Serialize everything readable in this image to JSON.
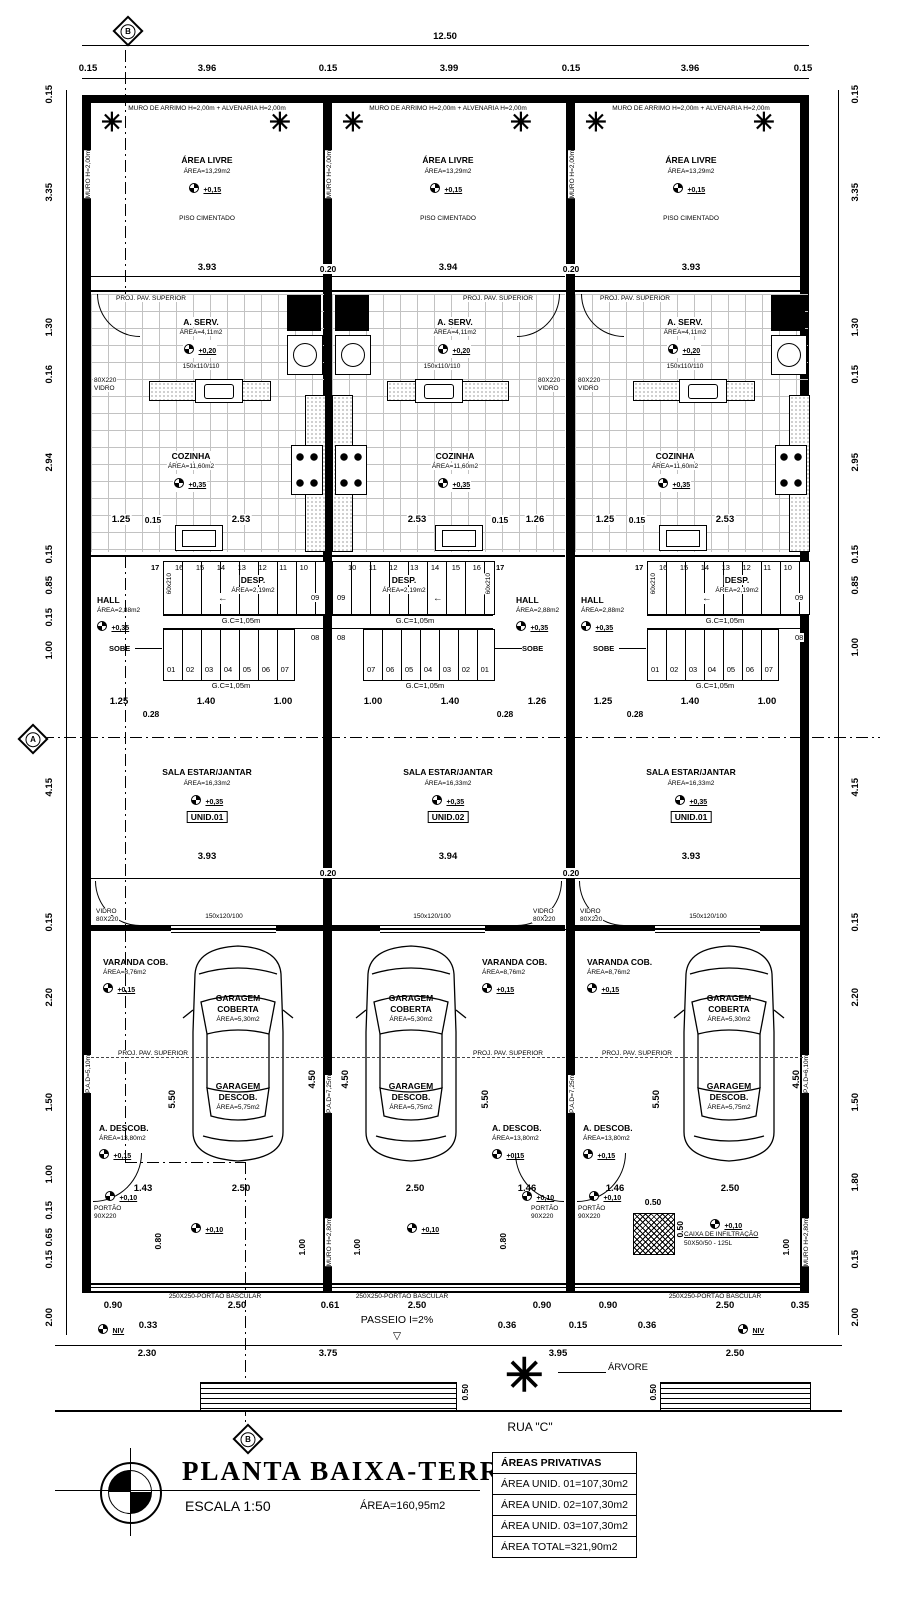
{
  "markers": {
    "a": "A",
    "b": "B"
  },
  "icons": {
    "palm": "✳",
    "arrow_left": "←",
    "triangle_down": "▽"
  },
  "dims": {
    "total": "12.50",
    "top": [
      "0.15",
      "3.96",
      "0.15",
      "3.99",
      "0.15",
      "3.96",
      "0.15"
    ],
    "left": [
      "0.15",
      "3.35",
      "1.30",
      "0.16",
      "2.94",
      "0.15",
      "0.85",
      "0.15",
      "1.00",
      "4.15",
      "0.15",
      "2.20",
      "1.50",
      "1.00",
      "0.15",
      "0.65",
      "0.15",
      "2.00"
    ],
    "right": [
      "0.15",
      "3.35",
      "1.30",
      "0.15",
      "2.95",
      "0.15",
      "0.85",
      "1.00",
      "4.15",
      "0.15",
      "2.20",
      "1.50",
      "1.80",
      "0.15",
      "2.00"
    ],
    "wall_020": "0.20"
  },
  "walls": {
    "muro_side": "MURO H=2,00m",
    "muro_low": "MURO H=2,80m",
    "pad_left": "P.A.D=5,10m",
    "pad_mid": "P.A.D=7,25m",
    "pad_right": "P.A.D=6,10m"
  },
  "units": [
    {
      "tag": "UNID.01",
      "muro_top": "MURO DE ARRIMO H=2,00m + ALVENARIA H=2,00m",
      "area_livre": {
        "name": "ÁREA LIVRE",
        "area": "ÁREA=13,29m2",
        "level": "+0,15",
        "floor": "PISO CIMENTADO",
        "width": "3.93"
      },
      "proj_pav": "PROJ. PAV. SUPERIOR",
      "a_serv": {
        "name": "A. SERV.",
        "area": "ÁREA=4,11m2",
        "level": "+0,20",
        "window": "150x110/110"
      },
      "vidro_rear": {
        "l1": "80X220",
        "l2": "VIDRO"
      },
      "cozinha": {
        "name": "COZINHA",
        "area": "ÁREA=11,60m2",
        "level": "+0,35",
        "dims": [
          "1.25",
          "0.15",
          "2.53"
        ]
      },
      "desp": {
        "name": "DESP.",
        "area": "ÁREA=2,19m2",
        "door": "60x210"
      },
      "hall": {
        "name": "HALL",
        "area": "ÁREA=2,88m2",
        "level": "+0,35"
      },
      "stairs": {
        "first": "17",
        "top_numbers": [
          "16",
          "15",
          "14",
          "13",
          "12",
          "11",
          "10"
        ],
        "right_top": "09",
        "right_mid": "08",
        "bottom_numbers": [
          "01",
          "02",
          "03",
          "04",
          "05",
          "06",
          "07"
        ],
        "gc1": "G.C=1,05m",
        "gc2": "G.C=1,05m",
        "sobe": "SOBE"
      },
      "hall_dims": {
        "a": "1.25",
        "b": "1.40",
        "c": "1.00",
        "sub": "0.28"
      },
      "sala": {
        "name": "SALA ESTAR/JANTAR",
        "area": "ÁREA=16,33m2",
        "level": "+0,35",
        "width": "3.93"
      },
      "front": {
        "vidro_l1": "VIDRO",
        "vidro_l2": "80X220",
        "window": "150x120/100"
      },
      "varanda": {
        "name": "VARANDA COB.",
        "area": "ÁREA=8,76m2",
        "level": "+0,15"
      },
      "gar_cob": {
        "l1": "GARAGEM",
        "l2": "COBERTA",
        "area": "ÁREA=5,30m2"
      },
      "proj_pav_gar": "PROJ. PAV. SUPERIOR",
      "gar_desc": {
        "l1": "GARAGEM",
        "l2": "DESCOB.",
        "area": "ÁREA=5,75m2"
      },
      "a_descob": {
        "name": "A. DESCOB.",
        "area": "ÁREA=13,80m2",
        "level": "+0,15"
      },
      "v_dims": {
        "d1": "5.50",
        "d2": "4.50"
      },
      "gate_dims": {
        "a": "1.43",
        "b": "2.50"
      },
      "portao": {
        "l1": "PORTÃO",
        "l2": "90X220"
      },
      "small_dims": {
        "a": "0.80",
        "b": "1.00"
      },
      "level_10": "+0,10",
      "bascular": "250X250-PORTÃO BASCULAR"
    },
    {
      "tag": "UNID.02",
      "muro_top": "MURO DE ARRIMO H=2,00m + ALVENARIA H=2,00m",
      "area_livre": {
        "name": "ÁREA LIVRE",
        "area": "ÁREA=13,29m2",
        "level": "+0,15",
        "floor": "PISO CIMENTADO",
        "width": "3.94"
      },
      "proj_pav": "PROJ. PAV. SUPERIOR",
      "a_serv": {
        "name": "A. SERV.",
        "area": "ÁREA=4,11m2",
        "level": "+0,20",
        "window": "150x110/110"
      },
      "vidro_rear": {
        "l1": "80X220",
        "l2": "VIDRO"
      },
      "cozinha": {
        "name": "COZINHA",
        "area": "ÁREA=11,60m2",
        "level": "+0,35",
        "dims": [
          "2.53",
          "0.15",
          "1.26"
        ]
      },
      "desp": {
        "name": "DESP.",
        "area": "ÁREA=2,19m2",
        "door": "60x210"
      },
      "hall": {
        "name": "HALL",
        "area": "ÁREA=2,88m2",
        "level": "+0,35"
      },
      "stairs": {
        "first": "17",
        "top_numbers": [
          "10",
          "11",
          "12",
          "13",
          "14",
          "15",
          "16"
        ],
        "right_top": "09",
        "right_mid": "08",
        "bottom_numbers": [
          "07",
          "06",
          "05",
          "04",
          "03",
          "02",
          "01"
        ],
        "gc1": "G.C=1,05m",
        "gc2": "G.C=1,05m",
        "sobe": "SOBE"
      },
      "hall_dims": {
        "a": "1.00",
        "b": "1.40",
        "c": "1.26",
        "sub": "0.28"
      },
      "sala": {
        "name": "SALA ESTAR/JANTAR",
        "area": "ÁREA=16,33m2",
        "level": "+0,35",
        "width": "3.94"
      },
      "front": {
        "vidro_l1": "VIDRO",
        "vidro_l2": "80X220",
        "window": "150x120/100"
      },
      "varanda": {
        "name": "VARANDA COB.",
        "area": "ÁREA=8,76m2",
        "level": "+0,15"
      },
      "gar_cob": {
        "l1": "GARAGEM",
        "l2": "COBERTA",
        "area": "ÁREA=5,30m2"
      },
      "proj_pav_gar": "PROJ. PAV. SUPERIOR",
      "gar_desc": {
        "l1": "GARAGEM",
        "l2": "DESCOB.",
        "area": "ÁREA=5,75m2"
      },
      "a_descob": {
        "name": "A. DESCOB.",
        "area": "ÁREA=13,80m2",
        "level": "+0,15"
      },
      "v_dims": {
        "d1": "5.50",
        "d2": "4.50"
      },
      "gate_dims": {
        "a": "2.50",
        "b": "1.46"
      },
      "portao": {
        "l1": "PORTÃO",
        "l2": "90X220"
      },
      "small_dims": {
        "a": "0.80",
        "b": "1.00"
      },
      "level_10": "+0,10",
      "bascular": "250X250-PORTÃO BASCULAR"
    },
    {
      "tag": "UNID.01",
      "muro_top": "MURO DE ARRIMO H=2,00m + ALVENARIA H=2,00m",
      "area_livre": {
        "name": "ÁREA LIVRE",
        "area": "ÁREA=13,29m2",
        "level": "+0,15",
        "floor": "PISO CIMENTADO",
        "width": "3.93"
      },
      "proj_pav": "PROJ. PAV. SUPERIOR",
      "a_serv": {
        "name": "A. SERV.",
        "area": "ÁREA=4,11m2",
        "level": "+0,20",
        "window": "150x110/110"
      },
      "vidro_rear": {
        "l1": "80X220",
        "l2": "VIDRO"
      },
      "cozinha": {
        "name": "COZINHA",
        "area": "ÁREA=11,60m2",
        "level": "+0,35",
        "dims": [
          "1.25",
          "0.15",
          "2.53"
        ]
      },
      "desp": {
        "name": "DESP.",
        "area": "ÁREA=2,19m2",
        "door": "60x210"
      },
      "hall": {
        "name": "HALL",
        "area": "ÁREA=2,88m2",
        "level": "+0,35"
      },
      "stairs": {
        "first": "17",
        "top_numbers": [
          "16",
          "15",
          "14",
          "13",
          "12",
          "11",
          "10"
        ],
        "right_top": "09",
        "right_mid": "08",
        "bottom_numbers": [
          "01",
          "02",
          "03",
          "04",
          "05",
          "06",
          "07"
        ],
        "gc1": "G.C=1,05m",
        "gc2": "G.C=1,05m",
        "sobe": "SOBE"
      },
      "hall_dims": {
        "a": "1.25",
        "b": "1.40",
        "c": "1.00",
        "sub": "0.28"
      },
      "sala": {
        "name": "SALA ESTAR/JANTAR",
        "area": "ÁREA=16,33m2",
        "level": "+0,35",
        "width": "3.93"
      },
      "front": {
        "vidro_l1": "VIDRO",
        "vidro_l2": "80X220",
        "window": "150x120/100"
      },
      "varanda": {
        "name": "VARANDA COB.",
        "area": "ÁREA=8,76m2",
        "level": "+0,15"
      },
      "gar_cob": {
        "l1": "GARAGEM",
        "l2": "COBERTA",
        "area": "ÁREA=5,30m2"
      },
      "proj_pav_gar": "PROJ. PAV. SUPERIOR",
      "gar_desc": {
        "l1": "GARAGEM",
        "l2": "DESCOB.",
        "area": "ÁREA=5,75m2"
      },
      "a_descob": {
        "name": "A. DESCOB.",
        "area": "ÁREA=13,80m2",
        "level": "+0,15"
      },
      "v_dims": {
        "d1": "5.50",
        "d2": "4.50"
      },
      "gate_dims": {
        "a": "1.46",
        "b": "2.50"
      },
      "portao": {
        "l1": "PORTÃO",
        "l2": "90X220"
      },
      "small_dims": {
        "a": "0.80",
        "b": "1.00"
      },
      "level_10": "+0,10",
      "caixa": {
        "l1": "CAIXA DE INFILTRAÇÃO",
        "l2": "50X50/50 - 125L",
        "d1": "0.50",
        "d2": "0.50",
        "level": "+0,10"
      },
      "bascular": "250X250-PORTÃO BASCULAR"
    }
  ],
  "bottom": {
    "gate_row": [
      "0.90",
      "2.50",
      "0.61",
      "2.50",
      "0.90",
      "0.90",
      "2.50",
      "0.35"
    ],
    "sub_row": [
      "0.33",
      "0.36",
      "0.15",
      "0.36"
    ],
    "street_row": [
      "2.30",
      "3.75",
      "3.95",
      "2.50"
    ],
    "passeio": "PASSEIO  I=2%",
    "arvore": "ÁRVORE",
    "rua": "RUA  \"C\"",
    "planter_d": "0.50",
    "niv": "NIV"
  },
  "title_block": {
    "title": "PLANTA BAIXA-TERREO",
    "scale_label": "ESCALA    1:50",
    "area_label": "ÁREA=160,95m2"
  },
  "areas_table": {
    "header": "ÁREAS PRIVATIVAS",
    "rows": [
      "ÁREA  UNID.  01=107,30m2",
      "ÁREA  UNID.  02=107,30m2",
      "ÁREA  UNID.  03=107,30m2",
      "ÁREA  TOTAL=321,90m2"
    ]
  }
}
